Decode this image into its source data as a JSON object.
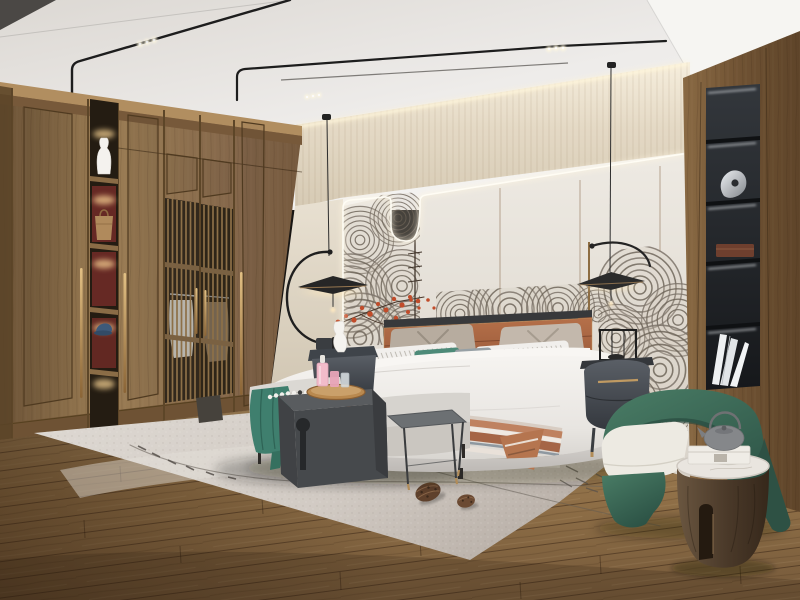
{
  "scene": {
    "type": "photograph",
    "room": "modern new-chinese style bedroom interior",
    "objects": [
      "tray ceiling with slim black track lights",
      "two black arc-arm pendant disc lamps",
      "full-wall wooden wardrobe with lattice screen doors",
      "lit wardrobe display shelves with white vase, tan handbag and blue cap",
      "feature wall panels outlined by an LED light line with center dip",
      "grey cloud-wave line artwork with red blossom branches",
      "upholstered bed with terracotta leather headboard",
      "white striped pillows, taupe pillows, teal accent pillow, bolster",
      "terracotta striped throw blanket",
      "dark oval nightstand with brass handle",
      "white ceramic vase and black wire lantern",
      "foot-of-bed bench with teal throw and bead garland",
      "charcoal waterfall side table with keyhole cutout",
      "wooden tray with pink perfume bottles and glasses",
      "slim metal nesting stool",
      "ivory area rug with thin line motif and two pinecones",
      "recessed black shelving niche with silver sculpture, wooden box and white books",
      "green barrel armchair with ivory seat cushion",
      "wooden drum side table with marble top",
      "grey cast-iron teapot and white box",
      "wide-plank oak floor"
    ]
  },
  "palette": {
    "ceiling": "#efedea",
    "wallpaper": "#e0d5c2",
    "wall_panel": "#e9e4dc",
    "trim_brown": "#8a6b4e",
    "led_glow": "#fff6e0",
    "wood_light": "#9a7c54",
    "wood_dark": "#6e5134",
    "wood_wall_right": "#7d5e3c",
    "niche_black": "#23262a",
    "art_line": "#6f665a",
    "blossom_red": "#c14c2a",
    "branch": "#4a382c",
    "headboard": "#a96644",
    "headboard_rail": "#38393b",
    "bedding_white": "#f1efec",
    "pillow_taupe": "#b7ac9f",
    "accent_teal": "#4d8a78",
    "pillow_gray": "#97a0a5",
    "blanket_terracotta": "#b5754f",
    "bed_base": "#d9d6d2",
    "bench_gray": "#d8d5d0",
    "throw_teal": "#3f7f6e",
    "charcoal": "#46494c",
    "stool_gray": "#6c7073",
    "tray_wood": "#b9894f",
    "bottle_pink": "#f2bcca",
    "glass_clear": "#dde3e6",
    "rug": "#d6d0ca",
    "rug_line": "#6c655e",
    "pinecone": "#5f412c",
    "chair_green": "#3f705d",
    "chair_green_dark": "#2e5144",
    "cushion_ivory": "#edeae2",
    "drum_wood": "#55422f",
    "marble_top": "#e9e5df",
    "teapot_gray": "#85878a",
    "box_white": "#efece6",
    "nightstand_dark": "#4d5157",
    "brass": "#bb9260",
    "rail_black": "#1d1d1d",
    "cable": "#2e2e2e",
    "floor_wood": "#96744b",
    "vase_white": "#f4f2ee",
    "cap_blue": "#3e5a7a",
    "bag_tan": "#b08a5c",
    "shelf_red": "#6d2a26",
    "book_white": "#eef0f1",
    "silver": "#c9cdd1"
  }
}
